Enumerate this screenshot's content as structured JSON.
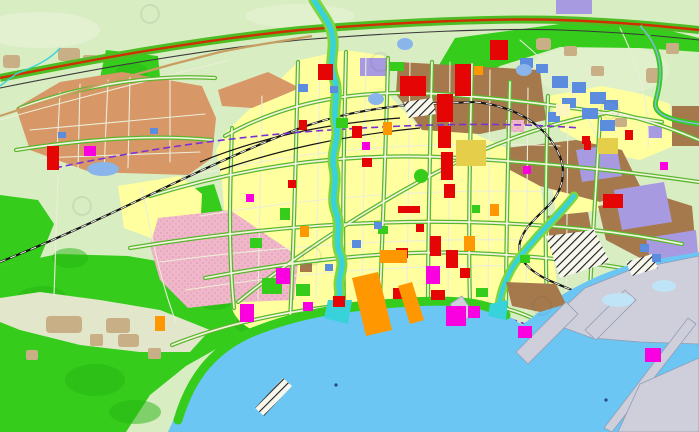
{
  "map": {
    "kind": "urban-master-plan-zoning-map",
    "water_labels": "none-visible",
    "legend_visible": false
  },
  "palette": {
    "rural": "#d9edc3",
    "rural_light": "#e9f4d8",
    "clearing": "#e2e7cb",
    "sea": "#6cc6f3",
    "sea_shallow": "#bfe3f7",
    "park": "#35cc1c",
    "park_dark": "#27b513",
    "village": "#c9af85",
    "residential": "#ffff9f",
    "pale_yellow": "#fdf6c0",
    "golden": "#e5ce4a",
    "commercial_red": "#e60505",
    "magenta": "#fa00e0",
    "orange": "#ff9800",
    "tan_industrial": "#d79767",
    "brown_industrial": "#a5794b",
    "lavender": "#a89ae0",
    "pink": "#f0b7ca",
    "pink_dot": "#dfa0b6",
    "blue_public": "#5b8cdd",
    "pond": "#8ab5ea",
    "river": "#38d3da",
    "river_bank": "#7fd63c",
    "road_green": "#58b82c",
    "road_fill": "#f4f3e0",
    "minor_road": "#eceed8",
    "rail": "#151515",
    "rail_dash": "#ffffff",
    "expressway_red": "#d03000",
    "expressway_green": "#4dbd24",
    "expressway_dark": "#3a3a3a",
    "secondary_road_tan": "#c89f63",
    "metro_purple": "#7b2fd6",
    "harbor_gray": "#cfcedb",
    "pier_gray": "#c7c6d2",
    "pier_edge": "#8f9db5",
    "hatch_bg": "#f7f7ee",
    "hatch_line": "#1a1a1a",
    "sea_marker": "#2b4a77",
    "watermark": "#555555"
  }
}
